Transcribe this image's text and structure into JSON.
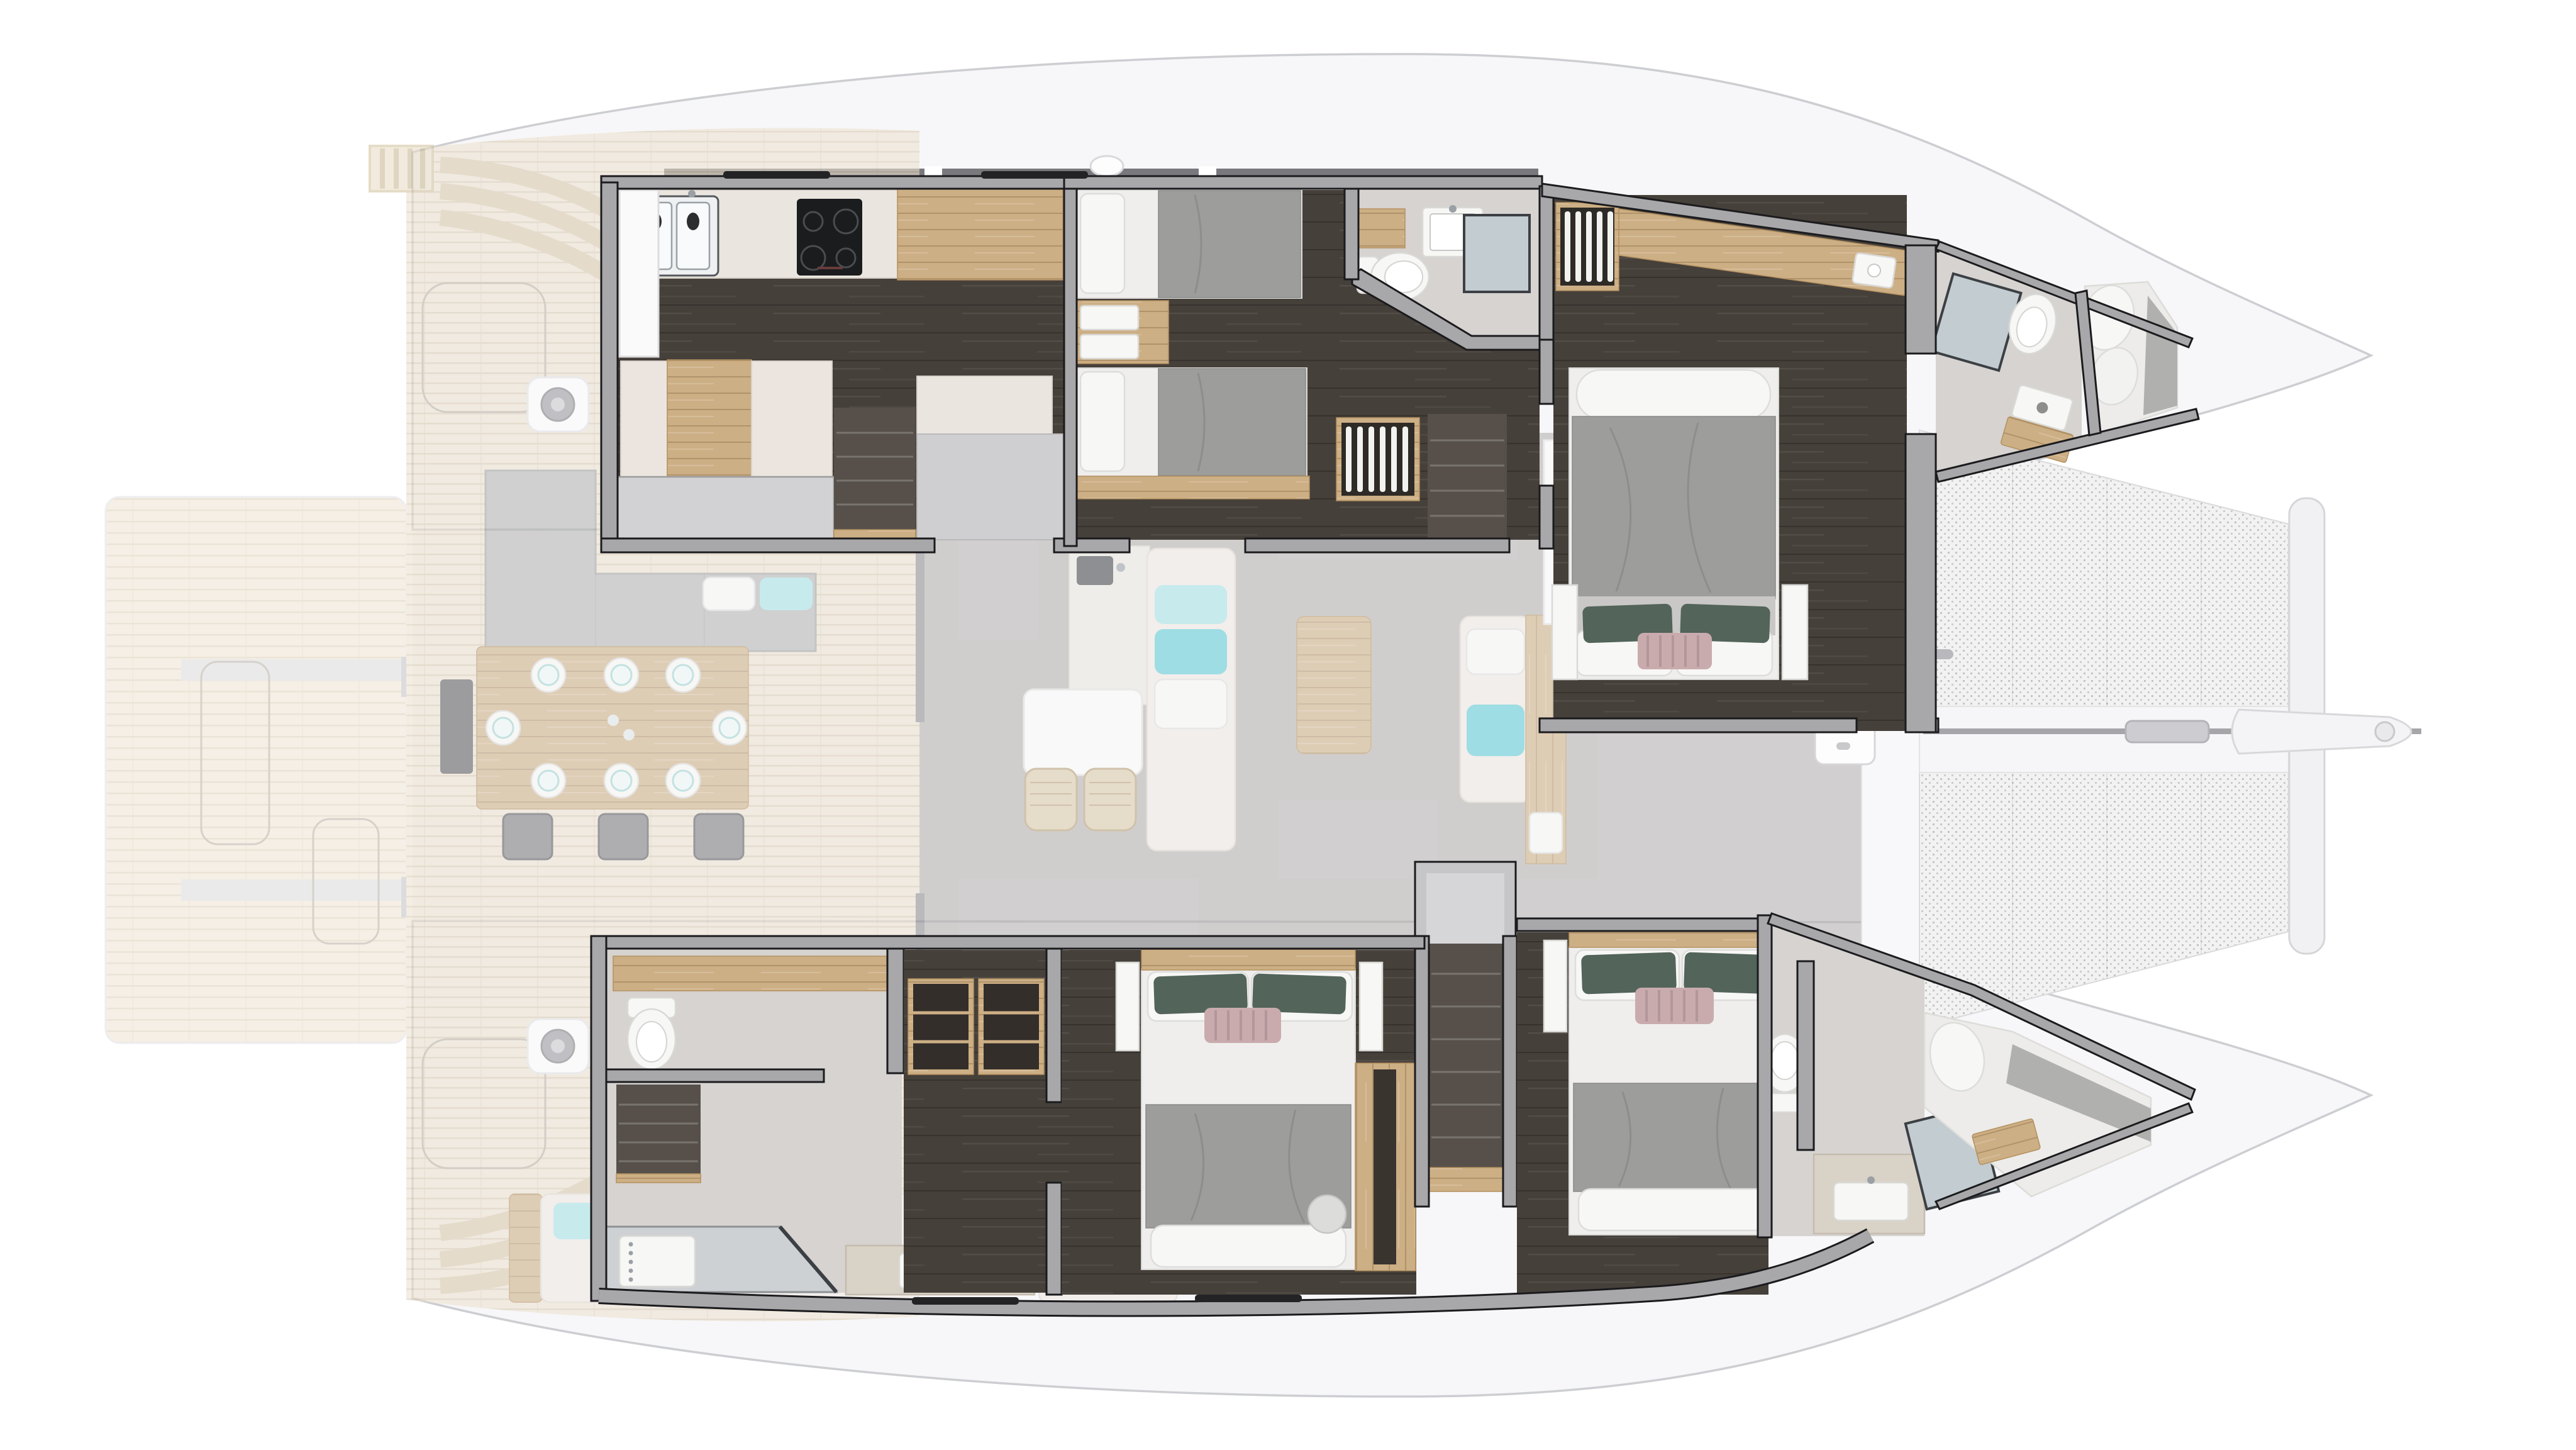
{
  "diagram": {
    "kind": "catamaran-yacht-accommodation-floor-plan",
    "view": "top-down cutaway render",
    "bow_direction": "right",
    "exterior_decks_rendering": "ghosted (semi-transparent)",
    "hull_interiors_rendering": "full-contrast cutaway"
  },
  "colors": {
    "bg": "#ffffff",
    "hull": "#f7f7f9",
    "hullLine": "#cdced2",
    "coach": "#6e6e72",
    "wall": "#a8a8ab",
    "wallLine": "#1b1b1e",
    "floorDark": "#46403a",
    "bath": "#d6d3d0",
    "teakBg": "#ece1cf",
    "teakLine": "#d9c9b2",
    "plankBg": "#efe5d4",
    "plankLine": "#ddcfba",
    "salonFloor": "#b5b2af",
    "oakBg": "#cdaf85",
    "oakLine": "#b3905f",
    "marble": "#eae6df",
    "marbleLine": "#d5d0c6",
    "steel": "#eef0f2",
    "steelLine": "#55585c",
    "appliance": "#1b1c1e",
    "burner": "#4a4c50",
    "whiteSoft": "#f7f7f5",
    "whiteLine": "#d9d9d6",
    "pillow": "#f7f7f5",
    "pillowLine": "#dddddb",
    "sheet": "#efeeec",
    "duvet": "#9d9d9c",
    "duvetLine": "#8a8a89",
    "pillowGreen": "#53645a",
    "pillowMauve": "#c9abae",
    "mauveStripe": "#b2969a",
    "teal": "#5fcbd4",
    "tealLight": "#a5e1e6",
    "cream": "#efe9e1",
    "creamLine": "#ded6cb",
    "greyBox": "#d2d2d4",
    "greyBoxLine": "#9c9c9e",
    "meshBg": "#f2f2f2",
    "meshDot": "#c4c4c4",
    "glass": "#c2ccd1",
    "glassFrame": "#3c4044",
    "stairs": "#57504a",
    "stairsLight": "rgba(255,255,255,0.20)",
    "ghostOutline": "#b9b1a4",
    "window": "#232326",
    "windlass": "#909094",
    "anchorLine": "#a6a6aa"
  },
  "exterior": {
    "swim_platform": {
      "hatch_outlines": 2,
      "non_skid_strips": 2,
      "hinges": 2
    },
    "aft_cockpit": {
      "dining_table_place_settings": 8,
      "dining_chairs": 3,
      "l_shaped_sofa_cushions": 3,
      "aft_sofa_cushions": 2,
      "winches": 2,
      "deck_hatch_outlines": 2,
      "stern_step_flights": 2,
      "boarding_ladder": 1
    },
    "foredeck": {
      "deck_hatches": 3,
      "windlass": 1
    },
    "bow": {
      "trampoline_panels": 2,
      "crossbeam": 1,
      "bowsprit": 1,
      "anchor_line": 1
    }
  },
  "salon": {
    "furniture": [
      "galley-up-counter-with-sink",
      "bar-table",
      "bar-stools-x2",
      "forward-sofa-with-teal-pillows",
      "coffee-table",
      "chaise-lounge",
      "oak-sideboard-with-coffee-machine",
      "dining-table",
      "dining-chairs-x4",
      "small-sofa",
      "armchair",
      "tall-galley-cabinet",
      "sliding-door-aft"
    ]
  },
  "port_hull": {
    "rooms": [
      {
        "id": "galley-down",
        "features": [
          "double-sink",
          "induction-cooktop-4-burner",
          "oak-cabinet",
          "settee-berth",
          "marble-island",
          "companionway-stairs",
          "escape-hatch"
        ]
      },
      {
        "id": "twin-guest-cabin",
        "features": [
          "single-bed-x2",
          "nightstand-with-trays",
          "hanging-locker",
          "companionway-stairs"
        ]
      },
      {
        "id": "twin-cabin-head",
        "features": [
          "toilet",
          "washbasin",
          "vanity",
          "shower"
        ]
      },
      {
        "id": "forward-owner-cabin",
        "features": [
          "double-bed",
          "decor-pillows",
          "hanging-locker",
          "oak-cabinet-band",
          "washbasin",
          "bedside-slabs-x2"
        ]
      },
      {
        "id": "forward-head",
        "features": [
          "shower",
          "toilet",
          "washbasin",
          "wood-tray"
        ]
      },
      {
        "id": "forepeak-berth",
        "features": [
          "mattress",
          "pillows"
        ]
      }
    ]
  },
  "starboard_hull": {
    "rooms": [
      {
        "id": "aft-head",
        "features": [
          "toilet",
          "oak-shelf",
          "companionway-stairs",
          "shower-with-glass-door",
          "vanity-washbasin"
        ]
      },
      {
        "id": "closet-corridor",
        "features": [
          "open-shelf-locker-x2"
        ]
      },
      {
        "id": "aft-guest-cabin",
        "features": [
          "double-bed",
          "decor-pillows",
          "bedside-slabs-x2",
          "oak-wardrobe"
        ]
      },
      {
        "id": "companionway",
        "features": [
          "stairs-from-salon",
          "vestibule"
        ]
      },
      {
        "id": "forward-guest-cabin",
        "features": [
          "double-bed",
          "decor-pillows",
          "bedside-slabs-x2"
        ]
      },
      {
        "id": "forward-head",
        "features": [
          "toilet",
          "vanity-washbasin",
          "shower-with-glass-door"
        ]
      },
      {
        "id": "forepeak-berth",
        "features": [
          "mattress",
          "pillow",
          "wood-tray"
        ]
      }
    ]
  },
  "counts": {
    "double_beds": 3,
    "single_beds": 2,
    "forepeak_berths": 2,
    "heads": 4,
    "showers": 4,
    "stair_flights": 5
  }
}
